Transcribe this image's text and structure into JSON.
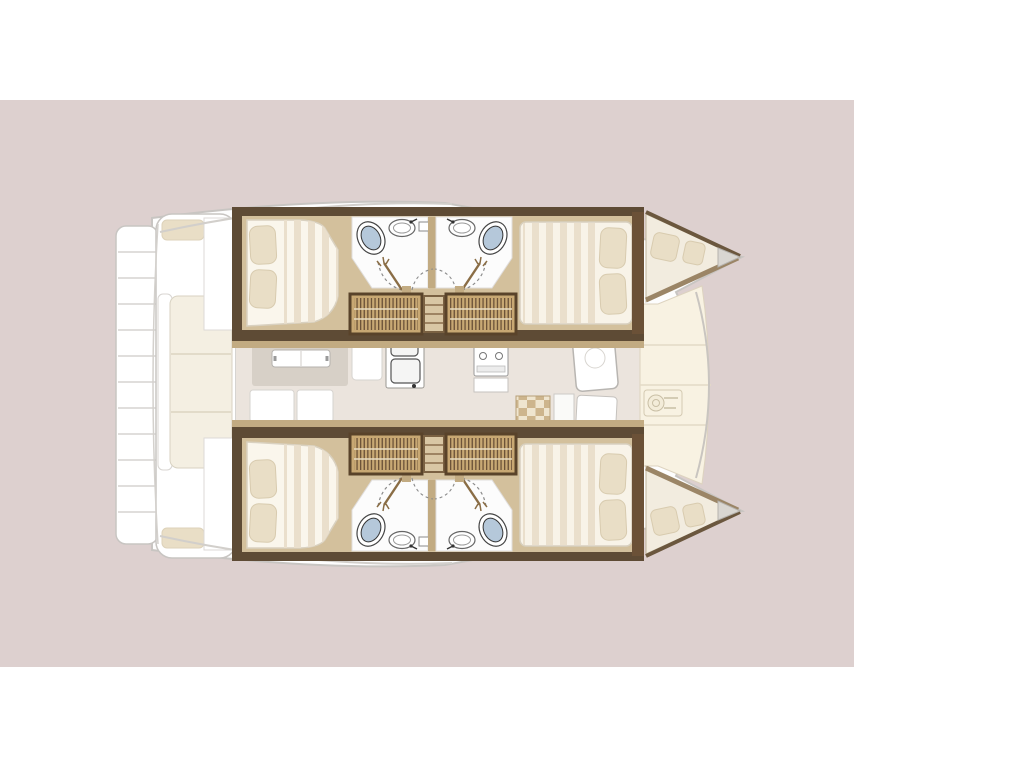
{
  "scene": {
    "description": "Top-down floor plan of a 4-cabin sailing catamaran, bow pointing right, shown on a dusty-pink panel over a white page",
    "orientation": "bow-right",
    "vessel_type": "catamaran"
  },
  "colors": {
    "page": "#ffffff",
    "panel-pink": "#ddd0cf",
    "boat-white": "#fdfdfd",
    "outline-gray": "#c8c5c2",
    "wood-light": "#d3c09c",
    "wood-mid": "#c2ab82",
    "wood-dark": "#5e4b35",
    "hatch-tan": "#c8a873",
    "hatch-frame": "#59432a",
    "bath-white": "#fcfcfc",
    "toilet-blue": "#b5c8da",
    "mattress": "#faf6ec",
    "mattress-stripe": "#eadfcc",
    "pillow": "#e9dec6",
    "deck-cream": "#f8f2e2",
    "salon-floor": "#ebe4dd"
  },
  "plan": {
    "hulls": [
      {
        "name": "port hull (top)",
        "rooms": [
          "aft double cabin",
          "aft bathroom",
          "forward bathroom",
          "forward double cabin"
        ],
        "fixtures": [
          "double bed with 2 pillows",
          "toilet",
          "washbasin",
          "toilet",
          "washbasin",
          "double bed with 2 pillows",
          "companionway hatch steps",
          "bow seat cushions"
        ]
      },
      {
        "name": "starboard hull (bottom)",
        "rooms": [
          "aft double cabin",
          "aft bathroom",
          "forward bathroom",
          "forward double cabin"
        ],
        "fixtures": [
          "double bed with 2 pillows",
          "toilet",
          "washbasin",
          "toilet",
          "washbasin",
          "double bed with 2 pillows",
          "companionway hatch steps",
          "bow seat cushions"
        ]
      }
    ],
    "center": {
      "rooms": [
        "salon / galley",
        "aft cockpit",
        "foredeck"
      ],
      "fixtures": [
        "dinette table",
        "sofa",
        "double galley sink",
        "stove",
        "floor grate mat",
        "windlass",
        "cockpit bench with cushions",
        "swim-platform steps"
      ]
    },
    "counts": {
      "cabins": 4,
      "bathrooms": 4,
      "toilets": 4,
      "sinks": 4,
      "beds": 4
    }
  }
}
